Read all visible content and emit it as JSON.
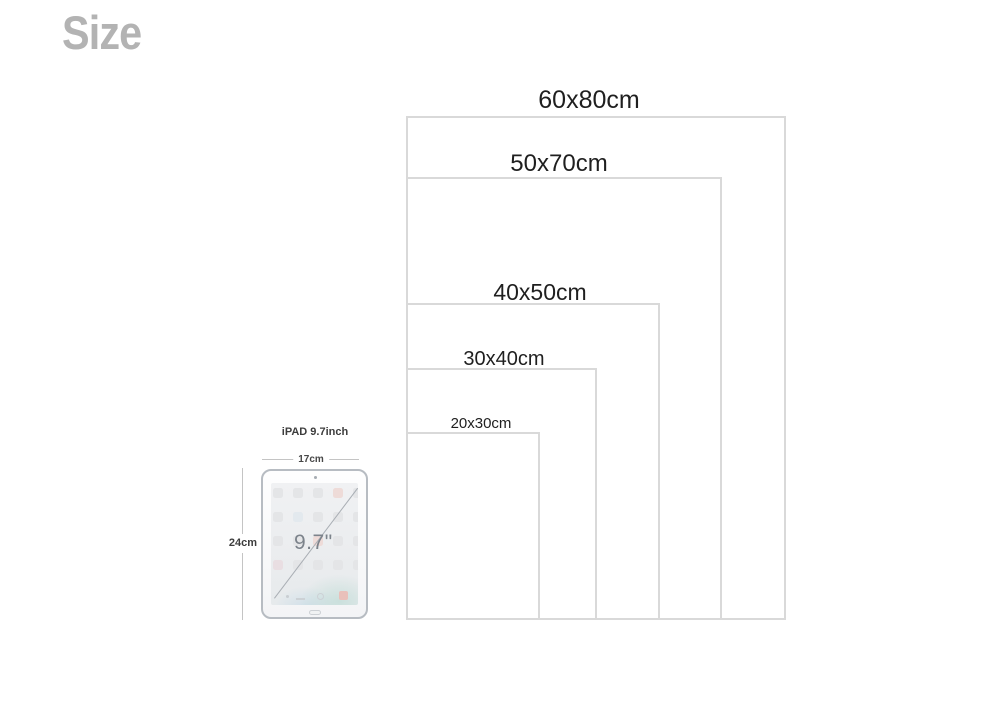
{
  "page": {
    "title": "Size",
    "title_color": "#b3b3b3",
    "background_color": "#ffffff",
    "rect_border_color": "#d9d9d9",
    "label_color": "#1f1f1f"
  },
  "sizes": [
    {
      "label": "60x80cm",
      "width_cm": 60,
      "height_cm": 80,
      "rect": {
        "x": 406,
        "y": 116,
        "w": 380,
        "h": 504
      },
      "label_pos": {
        "cx": 589,
        "top": 86,
        "font_size": 25
      }
    },
    {
      "label": "50x70cm",
      "width_cm": 50,
      "height_cm": 70,
      "rect": {
        "x": 406,
        "y": 177,
        "w": 316,
        "h": 443
      },
      "label_pos": {
        "cx": 559,
        "top": 150,
        "font_size": 24
      }
    },
    {
      "label": "40x50cm",
      "width_cm": 40,
      "height_cm": 50,
      "rect": {
        "x": 406,
        "y": 303,
        "w": 254,
        "h": 317
      },
      "label_pos": {
        "cx": 540,
        "top": 279,
        "font_size": 23
      }
    },
    {
      "label": "30x40cm",
      "width_cm": 30,
      "height_cm": 40,
      "rect": {
        "x": 406,
        "y": 368,
        "w": 191,
        "h": 252
      },
      "label_pos": {
        "cx": 504,
        "top": 348,
        "font_size": 20
      }
    },
    {
      "label": "20x30cm",
      "width_cm": 20,
      "height_cm": 30,
      "rect": {
        "x": 406,
        "y": 432,
        "w": 134,
        "h": 188
      },
      "label_pos": {
        "cx": 481,
        "top": 415,
        "font_size": 15
      }
    }
  ],
  "ipad": {
    "name_label": "iPAD 9.7inch",
    "width_label": "17cm",
    "height_label": "24cm",
    "diagonal_label": "9.7\"",
    "screen_icon_rows": 4,
    "screen_icon_cols": 5
  }
}
